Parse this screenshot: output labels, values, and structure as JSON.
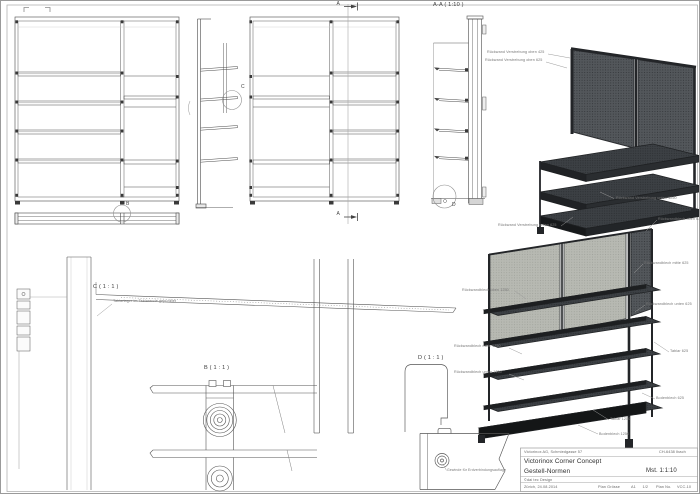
{
  "sheet": {
    "view_labels": {
      "section_top": "A",
      "section_bottom": "A",
      "section_title": "A-A ( 1:10 )",
      "detail_b_marker": "B",
      "detail_c_marker": "C",
      "detail_d_marker": "D",
      "detail_b_title": "B ( 1 : 1 )",
      "detail_c_title": "C ( 1 : 1 )",
      "detail_d_title": "D ( 1 : 1 )"
    },
    "notes": {
      "tablar": "Tablarlager im Tablarende gepunktet",
      "gewinde": "Gewinde für Erdverbindungsauflage"
    },
    "iso_top_callouts": [
      {
        "label": "Rückwand Verstrebung oben 425"
      },
      {
        "label": "Rückwand Verstrebung oben 625"
      },
      {
        "label": "Rückwand Verstrebung unten 1250"
      },
      {
        "label": "Rückwand Verstrebung unten 625"
      }
    ],
    "iso_bottom_callouts": [
      {
        "label": "Rückwandblech oben 625"
      },
      {
        "label": "Rückwandblech mitte 625"
      },
      {
        "label": "Rückwandblech unten 625"
      },
      {
        "label": "Rückwandblech oben 1250"
      },
      {
        "label": "Rückwandblech mitte 1250"
      },
      {
        "label": "Rückwandblech unten 1250"
      },
      {
        "label": "Tablar 625"
      },
      {
        "label": "Bodenblech 625"
      },
      {
        "label": "Tablar 1250"
      },
      {
        "label": "Bodenblech 1250"
      }
    ],
    "title_block": {
      "company": "Victorinox AG, Schmiedgasse 57",
      "city": "CH-6438 Ibach",
      "project": "Victorinox Corner Concept",
      "subtitle": "Gestell-Normen",
      "scale": "Mst. 1:1:10",
      "copyright": "©dai tec Design",
      "place_date": "Zürich, 24.08.2014",
      "size_label": "Plan Grösse",
      "size_value": "A1",
      "page_value": "1/2",
      "plan_no_label": "Plan No.",
      "plan_no_value": "VCC-10"
    },
    "colors": {
      "line": "#454545",
      "steel_dark": "#232528",
      "steel_mid": "#53575b",
      "panel_light": "#b7b9b2",
      "callout": "#777777"
    }
  }
}
